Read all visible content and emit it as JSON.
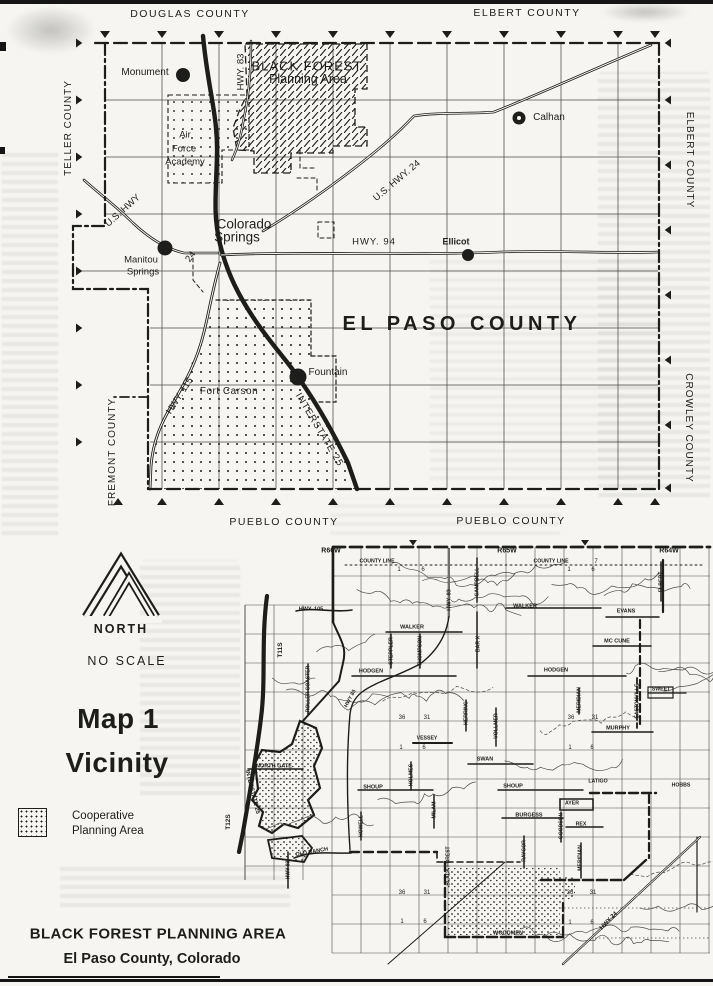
{
  "page": {
    "colors": {
      "ink": "#1d1d1b",
      "paper": "#f6f5f1"
    },
    "legend": {
      "north": "NORTH",
      "scale": "NO SCALE",
      "title_line1": "Map 1",
      "title_line2": "Vicinity",
      "swatch_line1": "Cooperative",
      "swatch_line2": "Planning Area"
    },
    "footer": {
      "line1": "BLACK FOREST PLANNING AREA",
      "line2": "El Paso County, Colorado"
    }
  },
  "top_map": {
    "labels": [
      {
        "n": "county-label-douglas",
        "t": "DOUGLAS COUNTY",
        "x": 190,
        "y": 14,
        "s": 10.5,
        "ls": 1.5
      },
      {
        "n": "county-label-elbert-top",
        "t": "ELBERT COUNTY",
        "x": 527,
        "y": 13,
        "s": 10.5,
        "ls": 1.5
      },
      {
        "n": "county-label-teller",
        "t": "TELLER COUNTY",
        "x": 69,
        "y": 128,
        "s": 10,
        "ls": 1,
        "r": -90
      },
      {
        "n": "county-label-elbert-right",
        "t": "ELBERT COUNTY",
        "x": 689,
        "y": 160,
        "s": 10,
        "ls": 1,
        "r": 90
      },
      {
        "n": "county-label-crowley",
        "t": "CROWLEY COUNTY",
        "x": 688,
        "y": 428,
        "s": 10,
        "ls": 1,
        "r": 90
      },
      {
        "n": "county-label-fremont",
        "t": "FREMONT COUNTY",
        "x": 113,
        "y": 452,
        "s": 10,
        "ls": 1,
        "r": -90
      },
      {
        "n": "county-label-pueblo-left",
        "t": "PUEBLO COUNTY",
        "x": 284,
        "y": 522,
        "s": 10.5,
        "ls": 1.5
      },
      {
        "n": "county-label-pueblo-right",
        "t": "PUEBLO COUNTY",
        "x": 511,
        "y": 521,
        "s": 10.5,
        "ls": 1.5
      },
      {
        "n": "county-label-el-paso",
        "t": "EL PASO COUNTY",
        "x": 462,
        "y": 324,
        "s": 20,
        "w": 700,
        "ls": 4.5
      },
      {
        "n": "city-label-monument",
        "t": "Monument",
        "x": 145,
        "y": 73,
        "s": 10
      },
      {
        "n": "city-label-calhan",
        "t": "Calhan",
        "x": 549,
        "y": 118,
        "s": 10
      },
      {
        "n": "city-label-colorado-springs-1",
        "t": "Colorado",
        "x": 244,
        "y": 224,
        "s": 13.5
      },
      {
        "n": "city-label-colorado-springs-2",
        "t": "Springs",
        "x": 237,
        "y": 237,
        "s": 13.5
      },
      {
        "n": "city-label-manitou-springs-1",
        "t": "Manitou",
        "x": 141,
        "y": 260,
        "s": 9.5
      },
      {
        "n": "city-label-manitou-springs-2",
        "t": "Springs",
        "x": 143,
        "y": 272,
        "s": 9.5
      },
      {
        "n": "city-label-ellicot",
        "t": "Ellicot",
        "x": 456,
        "y": 242,
        "s": 9,
        "w": 700
      },
      {
        "n": "city-label-fountain",
        "t": "Fountain",
        "x": 328,
        "y": 373,
        "s": 10
      },
      {
        "n": "road-label-hwy-83",
        "t": "HWY. 83",
        "x": 241,
        "y": 72,
        "s": 9.5,
        "r": -90
      },
      {
        "n": "road-label-us-hwy-24-west",
        "t": "U.S. HWY",
        "x": 123,
        "y": 211,
        "s": 9.5,
        "r": -42
      },
      {
        "n": "road-label-24-west",
        "t": "24",
        "x": 191,
        "y": 257,
        "s": 9.5,
        "r": -55
      },
      {
        "n": "road-label-us-hwy-24-east",
        "t": "U.S. HWY. 24",
        "x": 397,
        "y": 181,
        "s": 9.5,
        "r": -40
      },
      {
        "n": "road-label-hwy-94",
        "t": "HWY. 94",
        "x": 374,
        "y": 242,
        "s": 9.5,
        "ls": 1
      },
      {
        "n": "road-label-hwy-115",
        "t": "HWY. 115",
        "x": 180,
        "y": 396,
        "s": 9.5,
        "r": -57
      },
      {
        "n": "road-label-interstate-25",
        "t": "INTERSTATE 25",
        "x": 319,
        "y": 430,
        "s": 9.5,
        "ls": 1,
        "r": 59
      },
      {
        "n": "area-label-black-forest-1",
        "t": "BLACK FOREST",
        "x": 307,
        "y": 66,
        "s": 13,
        "ls": 1
      },
      {
        "n": "area-label-black-forest-2",
        "t": "Planning Area",
        "x": 308,
        "y": 79,
        "s": 12.5
      },
      {
        "n": "area-label-afa-1",
        "t": "Air",
        "x": 185,
        "y": 135,
        "s": 9.5
      },
      {
        "n": "area-label-afa-2",
        "t": "Force",
        "x": 184,
        "y": 149,
        "s": 9.5
      },
      {
        "n": "area-label-afa-3",
        "t": "Academy",
        "x": 185,
        "y": 162,
        "s": 9.5
      },
      {
        "n": "area-label-fort-carson",
        "t": "Fort Carson",
        "x": 229,
        "y": 392,
        "s": 10,
        "ls": 0.5
      }
    ]
  },
  "bottom_map": {
    "labels": [
      {
        "n": "range-label-r66w",
        "t": "R66W",
        "x": 331,
        "y": 551,
        "s": 7,
        "w": 700
      },
      {
        "n": "range-label-r65w",
        "t": "R65W",
        "x": 507,
        "y": 551,
        "s": 7,
        "w": 700
      },
      {
        "n": "range-label-r64w",
        "t": "R64W",
        "x": 669,
        "y": 551,
        "s": 7,
        "w": 700
      },
      {
        "n": "township-label-t11s",
        "t": "T11S",
        "x": 281,
        "y": 650,
        "s": 6.5,
        "w": 700,
        "r": -90
      },
      {
        "n": "township-label-t12s",
        "t": "T12S",
        "x": 229,
        "y": 822,
        "s": 6.5,
        "w": 700,
        "r": -90
      },
      {
        "n": "road-label-county-line-1",
        "t": "COUNTY LINE",
        "x": 377,
        "y": 562,
        "s": 5.2,
        "w": 700
      },
      {
        "n": "road-label-county-line-2",
        "t": "COUNTY LINE",
        "x": 551,
        "y": 562,
        "s": 5.2,
        "w": 700
      },
      {
        "n": "road-label-hwy-105",
        "t": "HWY. 105",
        "x": 311,
        "y": 610,
        "s": 5.5,
        "w": 700
      },
      {
        "n": "road-label-walker-1",
        "t": "WALKER",
        "x": 412,
        "y": 628,
        "s": 5.5,
        "w": 700
      },
      {
        "n": "road-label-walker-2",
        "t": "WALKER",
        "x": 525,
        "y": 607,
        "s": 5.5,
        "w": 700
      },
      {
        "n": "road-label-evans",
        "t": "EVANS",
        "x": 626,
        "y": 612,
        "s": 5.5,
        "w": 700
      },
      {
        "n": "road-label-mccune",
        "t": "MC CUNE",
        "x": 617,
        "y": 642,
        "s": 5.5,
        "w": 700
      },
      {
        "n": "road-label-hodgen-1",
        "t": "HODGEN",
        "x": 371,
        "y": 672,
        "s": 5.5,
        "w": 700
      },
      {
        "n": "road-label-hodgen-2",
        "t": "HODGEN",
        "x": 556,
        "y": 671,
        "s": 5.5,
        "w": 700
      },
      {
        "n": "road-label-murphy",
        "t": "MURPHY",
        "x": 618,
        "y": 729,
        "s": 5.5,
        "w": 700
      },
      {
        "n": "road-label-sweet",
        "t": "SWEET",
        "x": 661,
        "y": 690,
        "s": 5.2,
        "w": 700
      },
      {
        "n": "road-label-vessey",
        "t": "VESSEY",
        "x": 427,
        "y": 739,
        "s": 5.2,
        "w": 700
      },
      {
        "n": "road-label-swan",
        "t": "SWAN",
        "x": 485,
        "y": 760,
        "s": 5.5,
        "w": 700
      },
      {
        "n": "road-label-shoup-1",
        "t": "SHOUP",
        "x": 373,
        "y": 788,
        "s": 5.5,
        "w": 700
      },
      {
        "n": "road-label-shoup-2",
        "t": "SHOUP",
        "x": 513,
        "y": 787,
        "s": 5.5,
        "w": 700
      },
      {
        "n": "road-label-latigo",
        "t": "LATIGO",
        "x": 598,
        "y": 782,
        "s": 5.2,
        "w": 700
      },
      {
        "n": "road-label-hobbs",
        "t": "HOBBS",
        "x": 681,
        "y": 786,
        "s": 5.2,
        "w": 700
      },
      {
        "n": "road-label-ayer",
        "t": "AYER",
        "x": 572,
        "y": 804,
        "s": 5.2,
        "w": 700
      },
      {
        "n": "road-label-burgess",
        "t": "BURGESS",
        "x": 529,
        "y": 816,
        "s": 5.5,
        "w": 700
      },
      {
        "n": "road-label-rex",
        "t": "REX",
        "x": 581,
        "y": 825,
        "s": 5.2,
        "w": 700
      },
      {
        "n": "road-label-woodmen",
        "t": "WOODMEN",
        "x": 508,
        "y": 934,
        "s": 5.5,
        "w": 700
      },
      {
        "n": "road-label-old-ranch",
        "t": "OLD RANCH",
        "x": 312,
        "y": 853,
        "s": 5.5,
        "w": 700,
        "r": -10
      },
      {
        "n": "road-label-north-gate",
        "t": "NORTH GATE",
        "x": 274,
        "y": 767,
        "s": 5.5,
        "w": 700
      },
      {
        "n": "road-label-hwy-83-top",
        "t": "HWY. 83",
        "x": 450,
        "y": 600,
        "s": 5.5,
        "w": 700,
        "r": -90
      },
      {
        "n": "road-label-campbell",
        "t": "CAMPBELL",
        "x": 478,
        "y": 582,
        "s": 5.2,
        "w": 700,
        "r": -90
      },
      {
        "n": "road-label-bar-x",
        "t": "BAR X",
        "x": 479,
        "y": 644,
        "s": 5.2,
        "w": 700,
        "r": -90
      },
      {
        "n": "road-label-steppler",
        "t": "STEPPLER",
        "x": 392,
        "y": 651,
        "s": 5.2,
        "w": 700,
        "r": -90
      },
      {
        "n": "road-label-thompson",
        "t": "THOMPSON",
        "x": 421,
        "y": 651,
        "s": 5.2,
        "w": 700,
        "r": -90
      },
      {
        "n": "road-label-roller-coaster",
        "t": "ROLLER COASTER",
        "x": 309,
        "y": 689,
        "s": 5,
        "w": 700,
        "r": -90
      },
      {
        "n": "road-label-herring",
        "t": "HERRING",
        "x": 467,
        "y": 713,
        "s": 5.2,
        "w": 700,
        "r": -90
      },
      {
        "n": "road-label-vollmer",
        "t": "VOLLMER",
        "x": 497,
        "y": 726,
        "s": 5.2,
        "w": 700,
        "r": -90
      },
      {
        "n": "road-label-meridian-1",
        "t": "MERIDIAN",
        "x": 580,
        "y": 700,
        "s": 5.2,
        "w": 700,
        "r": -90
      },
      {
        "n": "road-label-meridian-2",
        "t": "MERIDIAN",
        "x": 581,
        "y": 858,
        "s": 5.2,
        "w": 700,
        "r": -90
      },
      {
        "n": "road-label-eastonville",
        "t": "EASTONVILLE",
        "x": 638,
        "y": 701,
        "s": 5,
        "w": 700,
        "r": -90
      },
      {
        "n": "road-label-elbert",
        "t": "ELBERT",
        "x": 662,
        "y": 582,
        "s": 5.2,
        "w": 700,
        "r": -90
      },
      {
        "n": "road-label-holmes",
        "t": "HOLMES",
        "x": 412,
        "y": 775,
        "s": 5.2,
        "w": 700,
        "r": -90
      },
      {
        "n": "road-label-milam",
        "t": "MILAM",
        "x": 435,
        "y": 810,
        "s": 5.2,
        "w": 700,
        "r": -90
      },
      {
        "n": "road-label-howell",
        "t": "HOWELL",
        "x": 362,
        "y": 826,
        "s": 5,
        "w": 700,
        "r": -90
      },
      {
        "n": "road-label-goodson",
        "t": "GOODSON",
        "x": 562,
        "y": 826,
        "s": 5,
        "w": 700,
        "r": -90
      },
      {
        "n": "road-label-raygor",
        "t": "RAYGOR",
        "x": 525,
        "y": 851,
        "s": 5,
        "w": 700,
        "r": -90
      },
      {
        "n": "road-label-hwy-83-south",
        "t": "HWY 83",
        "x": 289,
        "y": 870,
        "s": 5,
        "w": 700,
        "r": -90
      },
      {
        "n": "road-label-black-forest",
        "t": "BLACK FOREST",
        "x": 449,
        "y": 866,
        "s": 5,
        "w": 700,
        "r": -90
      },
      {
        "n": "road-label-hwy-83-mid",
        "t": "HWY 83",
        "x": 351,
        "y": 699,
        "s": 5.2,
        "w": 700,
        "r": -62
      },
      {
        "n": "road-label-interstate-25-bottom",
        "t": "INTERSTATE 25",
        "x": 252,
        "y": 792,
        "s": 6,
        "w": 700,
        "r": 76
      },
      {
        "n": "road-label-hwy-24-bottom",
        "t": "HWY 24",
        "x": 609,
        "y": 921,
        "s": 6,
        "w": 700,
        "r": -46
      }
    ],
    "sections": [
      {
        "t": "1",
        "x": 399,
        "y": 570
      },
      {
        "t": "6",
        "x": 423,
        "y": 570
      },
      {
        "t": "1",
        "x": 569,
        "y": 570
      },
      {
        "t": "6",
        "x": 593,
        "y": 570
      },
      {
        "t": "7",
        "x": 596,
        "y": 562
      },
      {
        "t": "36",
        "x": 402,
        "y": 718
      },
      {
        "t": "31",
        "x": 427,
        "y": 718
      },
      {
        "t": "36",
        "x": 571,
        "y": 718
      },
      {
        "t": "31",
        "x": 595,
        "y": 718
      },
      {
        "t": "1",
        "x": 401,
        "y": 748
      },
      {
        "t": "6",
        "x": 424,
        "y": 748
      },
      {
        "t": "1",
        "x": 570,
        "y": 748
      },
      {
        "t": "6",
        "x": 592,
        "y": 748
      },
      {
        "t": "36",
        "x": 402,
        "y": 893
      },
      {
        "t": "31",
        "x": 427,
        "y": 893
      },
      {
        "t": "36",
        "x": 570,
        "y": 893
      },
      {
        "t": "31",
        "x": 593,
        "y": 893
      },
      {
        "t": "1",
        "x": 402,
        "y": 922
      },
      {
        "t": "6",
        "x": 425,
        "y": 922
      },
      {
        "t": "1",
        "x": 570,
        "y": 923
      },
      {
        "t": "6",
        "x": 592,
        "y": 923
      }
    ]
  }
}
